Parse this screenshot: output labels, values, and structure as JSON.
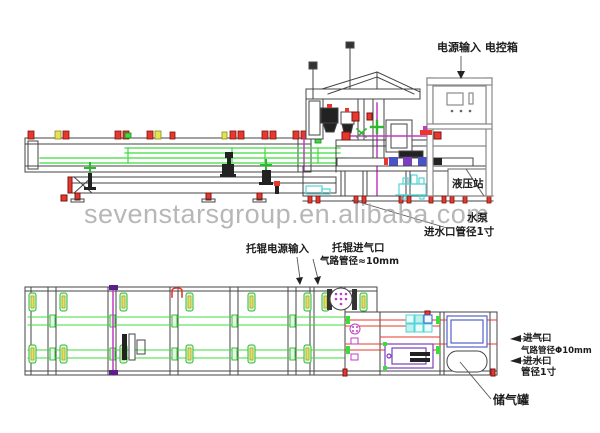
{
  "watermark": "sevenstarsgroup.en.alibaba.com",
  "labels": {
    "power_input": "电源输入  电控箱",
    "hydraulic_station": "液压站",
    "water_pump": "水泵",
    "water_pump_pipe": "进水口管径1寸",
    "roller_power": "托辊电源输入",
    "roller_air_inlet": "托辊进气口",
    "roller_air_pipe": "气路管径≈10mm",
    "air_inlet": "进气口",
    "air_inlet_pipe": "气路管径Φ10mm",
    "water_inlet": "进水口",
    "water_inlet_pipe": "管径1寸",
    "air_tank": "储气罐"
  },
  "colors": {
    "line": "#3a3a3a",
    "gray": "#8a8a8a",
    "red": "#e8372c",
    "green": "#3ddc3d",
    "yellow": "#e6e353",
    "magenta": "#c03cc0",
    "cyan": "#52d5d5",
    "blue": "#4a52c8",
    "purple": "#7a3fbf",
    "watermark_gray": "#a8a8a8"
  }
}
